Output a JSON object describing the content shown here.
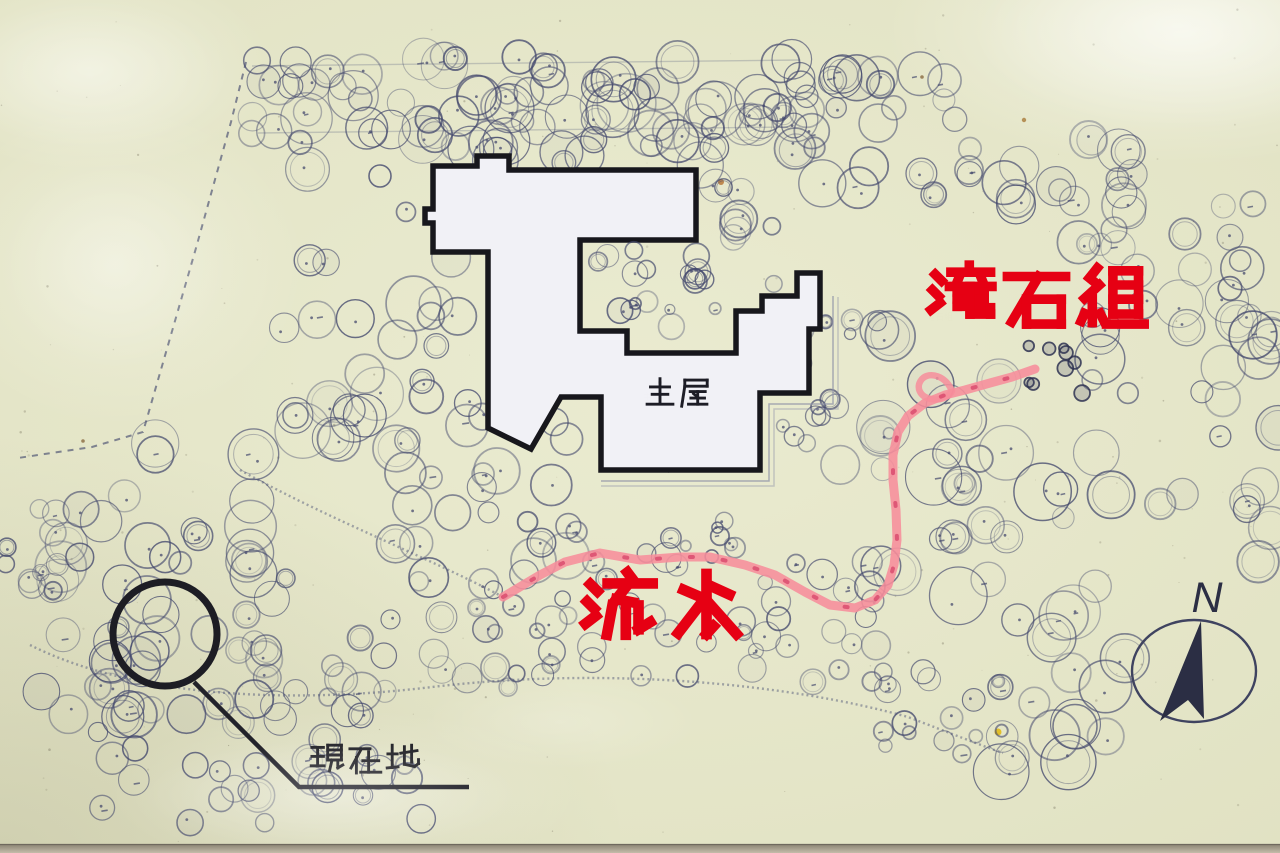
{
  "sign": {
    "description": "Hand-drawn Japanese garden site-map on an outdoor information sign",
    "palette": {
      "paper": "#e7e8cc",
      "ink": "#454a6e",
      "ink_dark": "#2c3050",
      "building_fill": "#f1f1f6",
      "building_outline": "#17171c",
      "label_red": "#e60013",
      "stream_pink": "#f78d9b",
      "stream_pink_dark": "#d8476b",
      "text_dark": "#26262c",
      "frame": "#a9a195"
    },
    "labels": {
      "main_house": {
        "text": "主屋",
        "x": 643,
        "y": 377,
        "size": 34,
        "gap": 3,
        "color": "#1d1d26",
        "weight": 8.5
      },
      "waterfall_stones": {
        "text": "滝石組",
        "x": 926,
        "y": 263,
        "size": 71,
        "gap": 4,
        "color": "#e60013",
        "weight": 13.5
      },
      "flowing_water": {
        "text": "流水",
        "x": 580,
        "y": 570,
        "size": 79,
        "gap": 8,
        "color": "#e60013",
        "weight": 13.5
      },
      "current_location": {
        "text": "現在地",
        "x": 309,
        "y": 742,
        "size": 36,
        "gap": 2,
        "color": "#26262c",
        "weight": 8
      },
      "north": {
        "text": "N"
      }
    },
    "features": {
      "building_outline_points": "433,166 477,166 477,156 509,156 509,170 696,170 696,240 580,240 580,331 627,331 627,353 736,353 736,311 762,311 762,296 797,296 797,273 820,273 820,329 809,329 809,393 760,393 760,470 601,470 601,397 561,397 531,449 488,428 488,252 433,252 433,223 425,223 425,209 433,209",
      "stream_points": "503,597 540,575 565,562 600,553 640,560 680,557 710,557 745,565 775,575 805,592 830,605 855,608 875,600 888,585 894,565 897,540 896,510 893,480 893,455 898,432 908,416 925,403 945,395 965,390 990,383 1012,377 1035,369",
      "stream_loop_d": "M 952,391 C 946,376 930,371 922,379 C 915,387 920,397 931,399 C 940,401 949,397 952,391",
      "current_location_marker": {
        "cx": 165,
        "cy": 634,
        "r": 52,
        "stroke_width": 7
      },
      "leader_points": "194,682 299,787 469,787",
      "boundary_points": "246,62 231,122 196,248 143,432 92,447 18,458",
      "compass": {
        "cx": 1194,
        "cy": 671,
        "rx": 62,
        "ry": 51,
        "arrow_points": "1201,621 1204,719 1188,700 1160,721",
        "label_x": 1207,
        "label_y": 612
      },
      "veranda_d": [
        "M 601,481 L 769,481 L 769,404 L 833,404 L 833,296",
        "M 601,486 L 774,486 L 774,409 L 838,409 L 838,297"
      ],
      "path_lines_d": [
        "M 30,645 C 140,700 300,703 432,687 C 610,666 790,684 908,717 C 950,733 980,745 1003,753",
        "M 240,470 C 330,520 430,558 503,597"
      ],
      "guide_lines": [
        "252,66 800,60",
        "258,133 788,127"
      ]
    }
  }
}
